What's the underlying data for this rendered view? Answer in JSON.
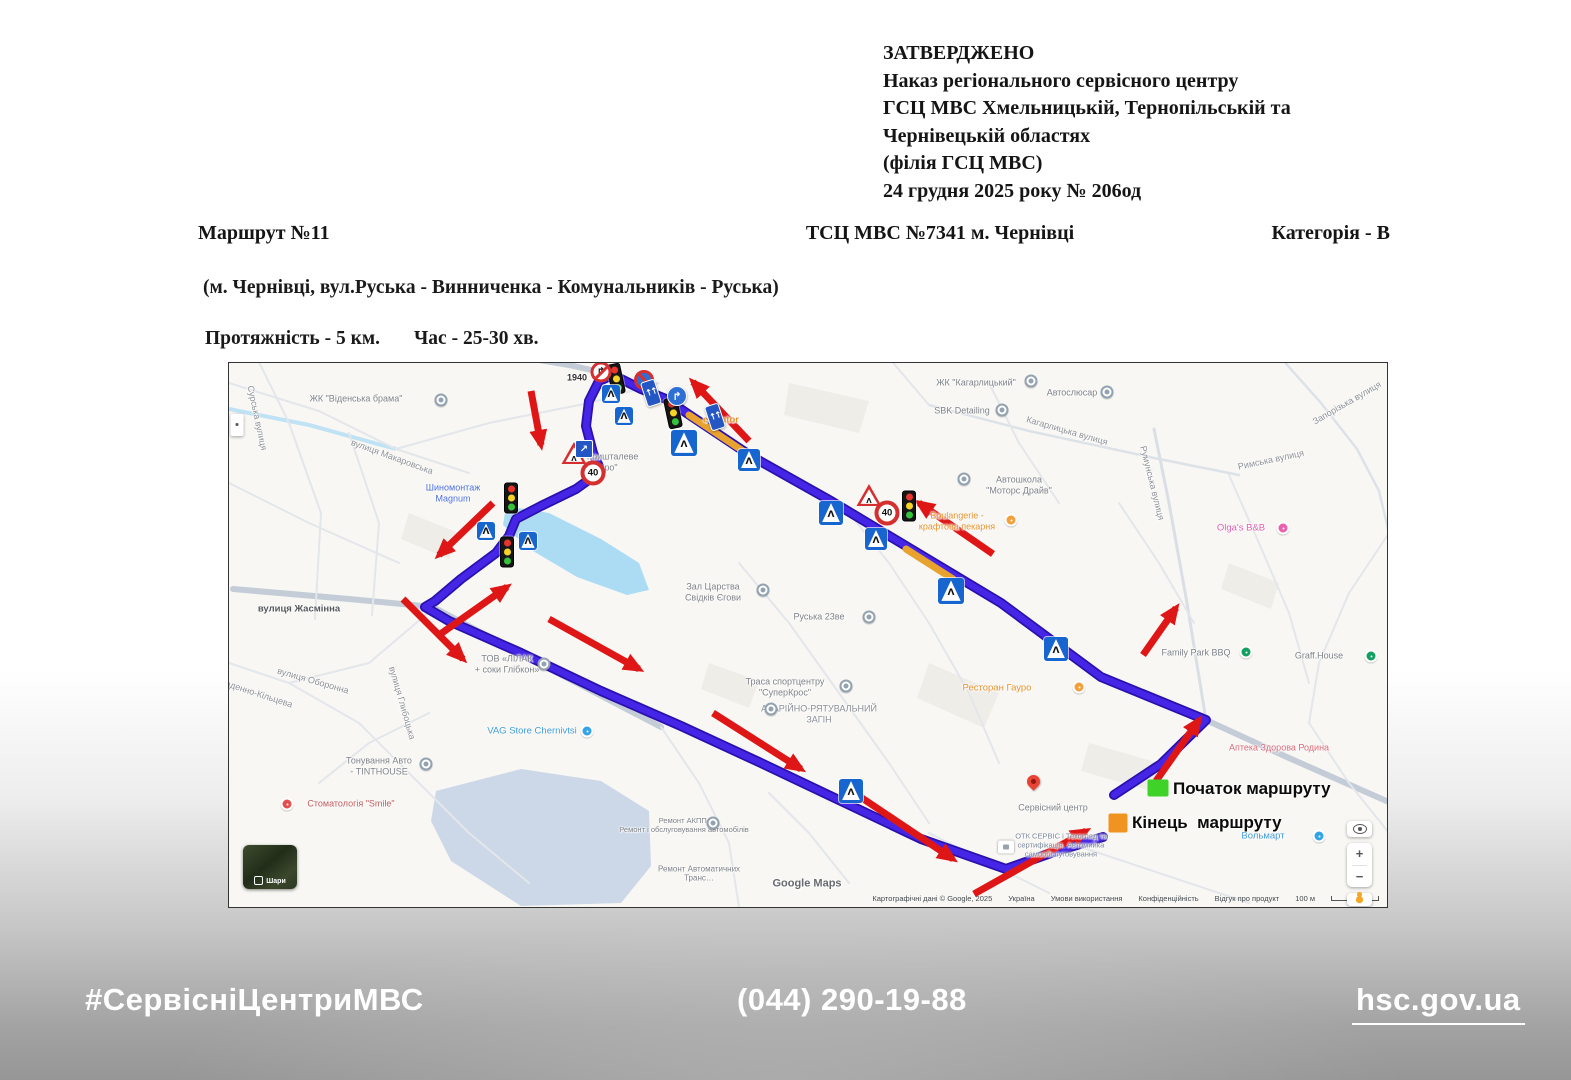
{
  "document": {
    "approval": {
      "lines": [
        "ЗАТВЕРДЖЕНО",
        "Наказ регіонального сервісного центру",
        "ГСЦ МВС Хмельницькій, Тернопільській та",
        "Чернівецькій областях",
        "(філія  ГСЦ МВС)",
        "24 грудня 2025 року № 206од"
      ]
    },
    "route_number": "Маршрут №11",
    "center_name": "ТСЦ МВС №7341 м. Чернівці",
    "category": "Категорія - В",
    "route_description": "(м. Чернівці, вул.Руська - Винниченка - Комунальників - Руська)",
    "distance": "Протяжність - 5 км.",
    "duration": "Час - 25-30 хв."
  },
  "footer": {
    "hashtag": "#СервісніЦентриМВС",
    "phone": "(044) 290-19-88",
    "site": "hsc.gov.ua"
  },
  "map": {
    "legend": {
      "start_label": "Початок маршруту",
      "end_label": "Кінець  маршруту"
    },
    "layers_label": "Шари",
    "controls": {
      "zoom_in": "+",
      "zoom_out": "−"
    },
    "attribution": {
      "items": [
        "Картографічні дані © Google, 2025",
        "Україна",
        "Умови використання",
        "Конфіденційність",
        "Відгук про продукт"
      ],
      "scale": "100 м"
    },
    "route": {
      "color": "#4526e6",
      "outline": "#2a10ad",
      "points": "885,432 932,401 977,357 872,314 772,240 677,183 602,138 522,93 462,53 437,36 412,26 390,15 384,12 370,18 360,38 357,63 364,90 372,108 347,126 312,143 287,156 280,173 267,190 232,216 206,238 196,244 220,258 292,290 372,328 452,363 532,400 612,438 692,476 777,506 822,490 874,474",
      "busy_segments": [
        "460,52 514,88",
        "677,186 724,216"
      ]
    },
    "arrows": [
      [
        302,
        28,
        312,
        82
      ],
      [
        520,
        78,
        464,
        19
      ],
      [
        264,
        140,
        210,
        192
      ],
      [
        210,
        272,
        278,
        224
      ],
      [
        174,
        236,
        234,
        296
      ],
      [
        320,
        256,
        410,
        306
      ],
      [
        484,
        350,
        572,
        406
      ],
      [
        630,
        433,
        724,
        496
      ],
      [
        745,
        531,
        857,
        468
      ],
      [
        927,
        418,
        970,
        357
      ],
      [
        764,
        191,
        690,
        140
      ],
      [
        914,
        292,
        947,
        245
      ]
    ],
    "water": {
      "river": "0,46 80,62 167,86",
      "lakes": [
        {
          "p": "277,143 320,150 372,176 410,200 420,227 398,232 348,214 299,185 274,162",
          "c": "#abdcf4"
        },
        {
          "p": "207,428 292,406 372,418 420,448 422,503 392,540 292,543 222,498 202,458",
          "c": "#ccd8e8"
        }
      ]
    },
    "blocks": [
      "560,20 640,38 630,70 555,52",
      "700,300 770,330 755,365 688,335",
      "180,150 230,170 220,196 172,176",
      "860,380 930,400 922,428 852,408",
      "1000,200 1050,220 1042,246 992,226",
      "480,300 530,318 520,345 472,326"
    ],
    "roads": [
      {
        "p": "4,226 120,236 204,244 300,295 432,364",
        "w": 6,
        "c": "#c3ccd7"
      },
      {
        "p": "292,-6 340,2 384,12",
        "w": 6,
        "c": "#c3ccd7"
      },
      {
        "p": "977,357 1060,395 1162,440",
        "w": 6,
        "c": "#c3ccd7"
      },
      {
        "p": "925,66 940,140 958,240 977,357",
        "w": 3,
        "c": "#d9dfe5"
      },
      {
        "p": "700,42 800,68 930,96 1010,112",
        "w": 2.5,
        "c": "#dde2e8"
      },
      {
        "p": "1052,-5 1092,40 1128,86 1150,128 1160,170",
        "w": 2.5,
        "c": "#dde2e8"
      },
      {
        "p": "660,-5 700,42",
        "w": 2
      },
      {
        "p": "0,20 90,48 167,86 240,110",
        "w": 2
      },
      {
        "p": "28,-5 60,60 92,150 86,256",
        "w": 2
      },
      {
        "p": "120,70 150,160 143,252",
        "w": 2
      },
      {
        "p": "0,120 80,160 170,200",
        "w": 2
      },
      {
        "p": "167,86 260,60 360,40 430,20",
        "w": 2
      },
      {
        "p": "60,320 140,300 206,244",
        "w": 2
      },
      {
        "p": "0,300 60,320 130,360 190,420 240,470 300,520",
        "w": 2
      },
      {
        "p": "90,420 140,380 200,350",
        "w": 2
      },
      {
        "p": "432,364 470,420 500,480 510,544",
        "w": 2
      },
      {
        "p": "620,150 660,200 700,260 740,330 770,400",
        "w": 2
      },
      {
        "p": "510,200 560,260 610,330 660,400 700,460",
        "w": 2
      },
      {
        "p": "760,20 790,80 830,140",
        "w": 2
      },
      {
        "p": "890,140 930,200 965,260",
        "w": 2
      },
      {
        "p": "1000,112 1030,180 1060,250 1080,320",
        "w": 2
      },
      {
        "p": "1160,170 1120,230 1090,300 1080,360",
        "w": 2
      },
      {
        "p": "1080,360 1120,420 1160,470",
        "w": 2
      },
      {
        "p": "840,480 900,500 960,520 1020,540",
        "w": 2
      },
      {
        "p": "700,470 760,500 820,530",
        "w": 2
      },
      {
        "p": "540,430 580,470 620,520",
        "w": 2
      }
    ],
    "signs": [
      {
        "type": "traffic_light",
        "x": 387,
        "y": 16,
        "r": -12
      },
      {
        "type": "traffic_light",
        "x": 444,
        "y": 50,
        "r": -12
      },
      {
        "type": "traffic_light",
        "x": 282,
        "y": 135
      },
      {
        "type": "traffic_light",
        "x": 278,
        "y": 189
      },
      {
        "type": "traffic_light",
        "x": 680,
        "y": 143
      },
      {
        "type": "crosswalk",
        "x": 382,
        "y": 31,
        "sz": 18
      },
      {
        "type": "crosswalk",
        "x": 395,
        "y": 53,
        "sz": 18
      },
      {
        "type": "crosswalk",
        "x": 455,
        "y": 80,
        "sz": 26
      },
      {
        "type": "crosswalk",
        "x": 520,
        "y": 97,
        "sz": 22
      },
      {
        "type": "crosswalk",
        "x": 602,
        "y": 150,
        "sz": 24
      },
      {
        "type": "crosswalk",
        "x": 647,
        "y": 176,
        "sz": 22
      },
      {
        "type": "crosswalk",
        "x": 722,
        "y": 228,
        "sz": 26
      },
      {
        "type": "crosswalk",
        "x": 827,
        "y": 286,
        "sz": 24
      },
      {
        "type": "crosswalk",
        "x": 622,
        "y": 428,
        "sz": 24
      },
      {
        "type": "crosswalk",
        "x": 257,
        "y": 168,
        "sz": 18
      },
      {
        "type": "crosswalk",
        "x": 299,
        "y": 178,
        "sz": 18
      },
      {
        "type": "speed",
        "x": 364,
        "y": 110,
        "label": "40"
      },
      {
        "type": "speed",
        "x": 658,
        "y": 150,
        "label": "40"
      },
      {
        "type": "warning",
        "x": 345,
        "y": 90
      },
      {
        "type": "warning",
        "x": 640,
        "y": 132
      },
      {
        "type": "no_right_turn",
        "x": 372,
        "y": 9
      },
      {
        "type": "no_stopping",
        "x": 415,
        "y": 17
      },
      {
        "type": "curve",
        "x": 448,
        "y": 33
      },
      {
        "type": "lane",
        "x": 422,
        "y": 30,
        "r": -18
      },
      {
        "type": "lane",
        "x": 486,
        "y": 54,
        "r": -18
      },
      {
        "type": "diag",
        "x": 355,
        "y": 86
      },
      {
        "type": "pin",
        "x": 804,
        "y": 428,
        "name": "service-center-pin"
      },
      {
        "type": "marker_green",
        "x": 929,
        "y": 425,
        "name": "route-start-marker"
      },
      {
        "type": "marker_orange",
        "x": 889,
        "y": 460,
        "name": "route-end-marker"
      },
      {
        "type": "white_box",
        "x": 777,
        "y": 484
      },
      {
        "type": "expander",
        "x": 8,
        "y": 62,
        "name": "map-side-panel"
      },
      {
        "type": "poi",
        "x": 212,
        "y": 37
      },
      {
        "type": "poi",
        "x": 802,
        "y": 18
      },
      {
        "type": "poi",
        "x": 878,
        "y": 29
      },
      {
        "type": "poi",
        "x": 773,
        "y": 47
      },
      {
        "type": "poi",
        "x": 534,
        "y": 227
      },
      {
        "type": "poi",
        "x": 640,
        "y": 254
      },
      {
        "type": "poi",
        "x": 617,
        "y": 323
      },
      {
        "type": "poi",
        "x": 315,
        "y": 301
      },
      {
        "type": "poi",
        "x": 197,
        "y": 401
      },
      {
        "type": "poi",
        "x": 484,
        "y": 460
      },
      {
        "type": "poi",
        "x": 735,
        "y": 116
      },
      {
        "type": "poi",
        "x": 542,
        "y": 346
      },
      {
        "type": "poi",
        "x": 358,
        "y": 368,
        "v": "blue"
      },
      {
        "type": "poi",
        "x": 1090,
        "y": 473,
        "v": "blue"
      },
      {
        "type": "poi",
        "x": 850,
        "y": 324,
        "v": "orange"
      },
      {
        "type": "poi",
        "x": 782,
        "y": 157,
        "v": "orange"
      },
      {
        "type": "poi",
        "x": 1054,
        "y": 165,
        "v": "pink"
      },
      {
        "type": "poi",
        "x": 1017,
        "y": 289,
        "v": "green"
      },
      {
        "type": "poi",
        "x": 1142,
        "y": 293,
        "v": "green"
      },
      {
        "type": "poi",
        "x": 58,
        "y": 441,
        "v": "red"
      }
    ],
    "labels": [
      {
        "t": "ЖК \"Віденська брама\"",
        "x": 127,
        "y": 36
      },
      {
        "t": "1940",
        "x": 348,
        "y": 15,
        "c": "#333333",
        "w": 600
      },
      {
        "t": "eQvator",
        "x": 492,
        "y": 57,
        "c": "#e8922c",
        "s": 9.5,
        "w": 600
      },
      {
        "t": "ЖК \"Кришталеве\nОзеро\"",
        "x": 374,
        "y": 99
      },
      {
        "t": "Шиномонтаж\nMagnum",
        "x": 224,
        "y": 130,
        "c": "#4a6fd8"
      },
      {
        "t": "вулиця Жасмінна",
        "x": 70,
        "y": 246,
        "c": "#55585c",
        "s": 9.5,
        "w": 600
      },
      {
        "t": "Зал Царства\nСвідків Єгови",
        "x": 484,
        "y": 229
      },
      {
        "t": "Руська 23ве",
        "x": 590,
        "y": 254
      },
      {
        "t": "Траса спортцентру\n\"СуперКрос\"",
        "x": 556,
        "y": 324
      },
      {
        "t": "АВАРІЙНО-РЯТУВАЛЬНИЙ\nЗАГІН",
        "x": 590,
        "y": 351,
        "c": "#8a8f94"
      },
      {
        "t": "ТОВ «ЛІЛАК\n+ соки Глібкон»",
        "x": 278,
        "y": 301
      },
      {
        "t": "VAG Store Chernivtsi",
        "x": 303,
        "y": 368,
        "c": "#3e9bd8",
        "s": 9.5
      },
      {
        "t": "Тонування Авто\n- TINTHOUSE",
        "x": 150,
        "y": 403
      },
      {
        "t": "Стоматологія \"Smile\"",
        "x": 122,
        "y": 441,
        "c": "#c05a5a"
      },
      {
        "t": "Ремонт АКПП-\nРемонт і обслуговування автомобілів",
        "x": 455,
        "y": 463,
        "s": 7.5
      },
      {
        "t": "Ремонт Автоматичних\nТранс…",
        "x": 470,
        "y": 511,
        "s": 8
      },
      {
        "t": "Google Maps",
        "x": 578,
        "y": 521,
        "c": "#666a6e",
        "s": 11,
        "w": 600
      },
      {
        "t": "Ресторан Гауро",
        "x": 768,
        "y": 325,
        "c": "#e8922c",
        "s": 9.5
      },
      {
        "t": "Сервісний центр",
        "x": 824,
        "y": 445
      },
      {
        "t": "ОТК СЕРВІС і Техогляд та\nсертифікація. Автомийка\nсамообслуговування",
        "x": 832,
        "y": 483,
        "s": 7.5,
        "c": "#7b8799"
      },
      {
        "t": "Вольмарт",
        "x": 1034,
        "y": 473,
        "c": "#3e9bd8",
        "s": 9.5
      },
      {
        "t": "Family Park BBQ",
        "x": 967,
        "y": 290
      },
      {
        "t": "Graff.House",
        "x": 1090,
        "y": 293
      },
      {
        "t": "Аптека Здорова Родина",
        "x": 1050,
        "y": 385,
        "c": "#d96a76"
      },
      {
        "t": "Olga's B&B",
        "x": 1012,
        "y": 165,
        "c": "#e060b0",
        "s": 9.5
      },
      {
        "t": "ЖК \"Кагарлицький\"",
        "x": 747,
        "y": 20
      },
      {
        "t": "Автослюсар",
        "x": 843,
        "y": 30
      },
      {
        "t": "SBK Detailing",
        "x": 733,
        "y": 48
      },
      {
        "t": "Кагарлицька вулиця",
        "x": 838,
        "y": 68,
        "r": 16,
        "c": "#8d9196"
      },
      {
        "t": "Автошкола\n\"Моторс Драйв\"",
        "x": 790,
        "y": 122
      },
      {
        "t": "Boulangerie -\nкрафтова пекарня",
        "x": 728,
        "y": 158,
        "c": "#e8922c"
      },
      {
        "t": "Румунська вулиця",
        "x": 923,
        "y": 120,
        "r": 76,
        "c": "#8d9196"
      },
      {
        "t": "Запорізька вулиця",
        "x": 1118,
        "y": 40,
        "r": -30,
        "c": "#8d9196"
      },
      {
        "t": "Римська вулиця",
        "x": 1042,
        "y": 97,
        "r": -12,
        "c": "#8d9196"
      },
      {
        "t": "Сурська вулиця",
        "x": 28,
        "y": 55,
        "r": 78,
        "c": "#8d9196"
      },
      {
        "t": "вулиця Макаровська",
        "x": 163,
        "y": 94,
        "r": 20,
        "c": "#8d9196"
      },
      {
        "t": "вулиця Оборонна",
        "x": 84,
        "y": 318,
        "r": 16,
        "c": "#8d9196"
      },
      {
        "t": "вулиця Глибоцька",
        "x": 173,
        "y": 340,
        "r": 74,
        "c": "#8d9196"
      },
      {
        "t": "Південно-Кільцева",
        "x": 26,
        "y": 330,
        "r": 18,
        "c": "#8d9196"
      }
    ]
  }
}
